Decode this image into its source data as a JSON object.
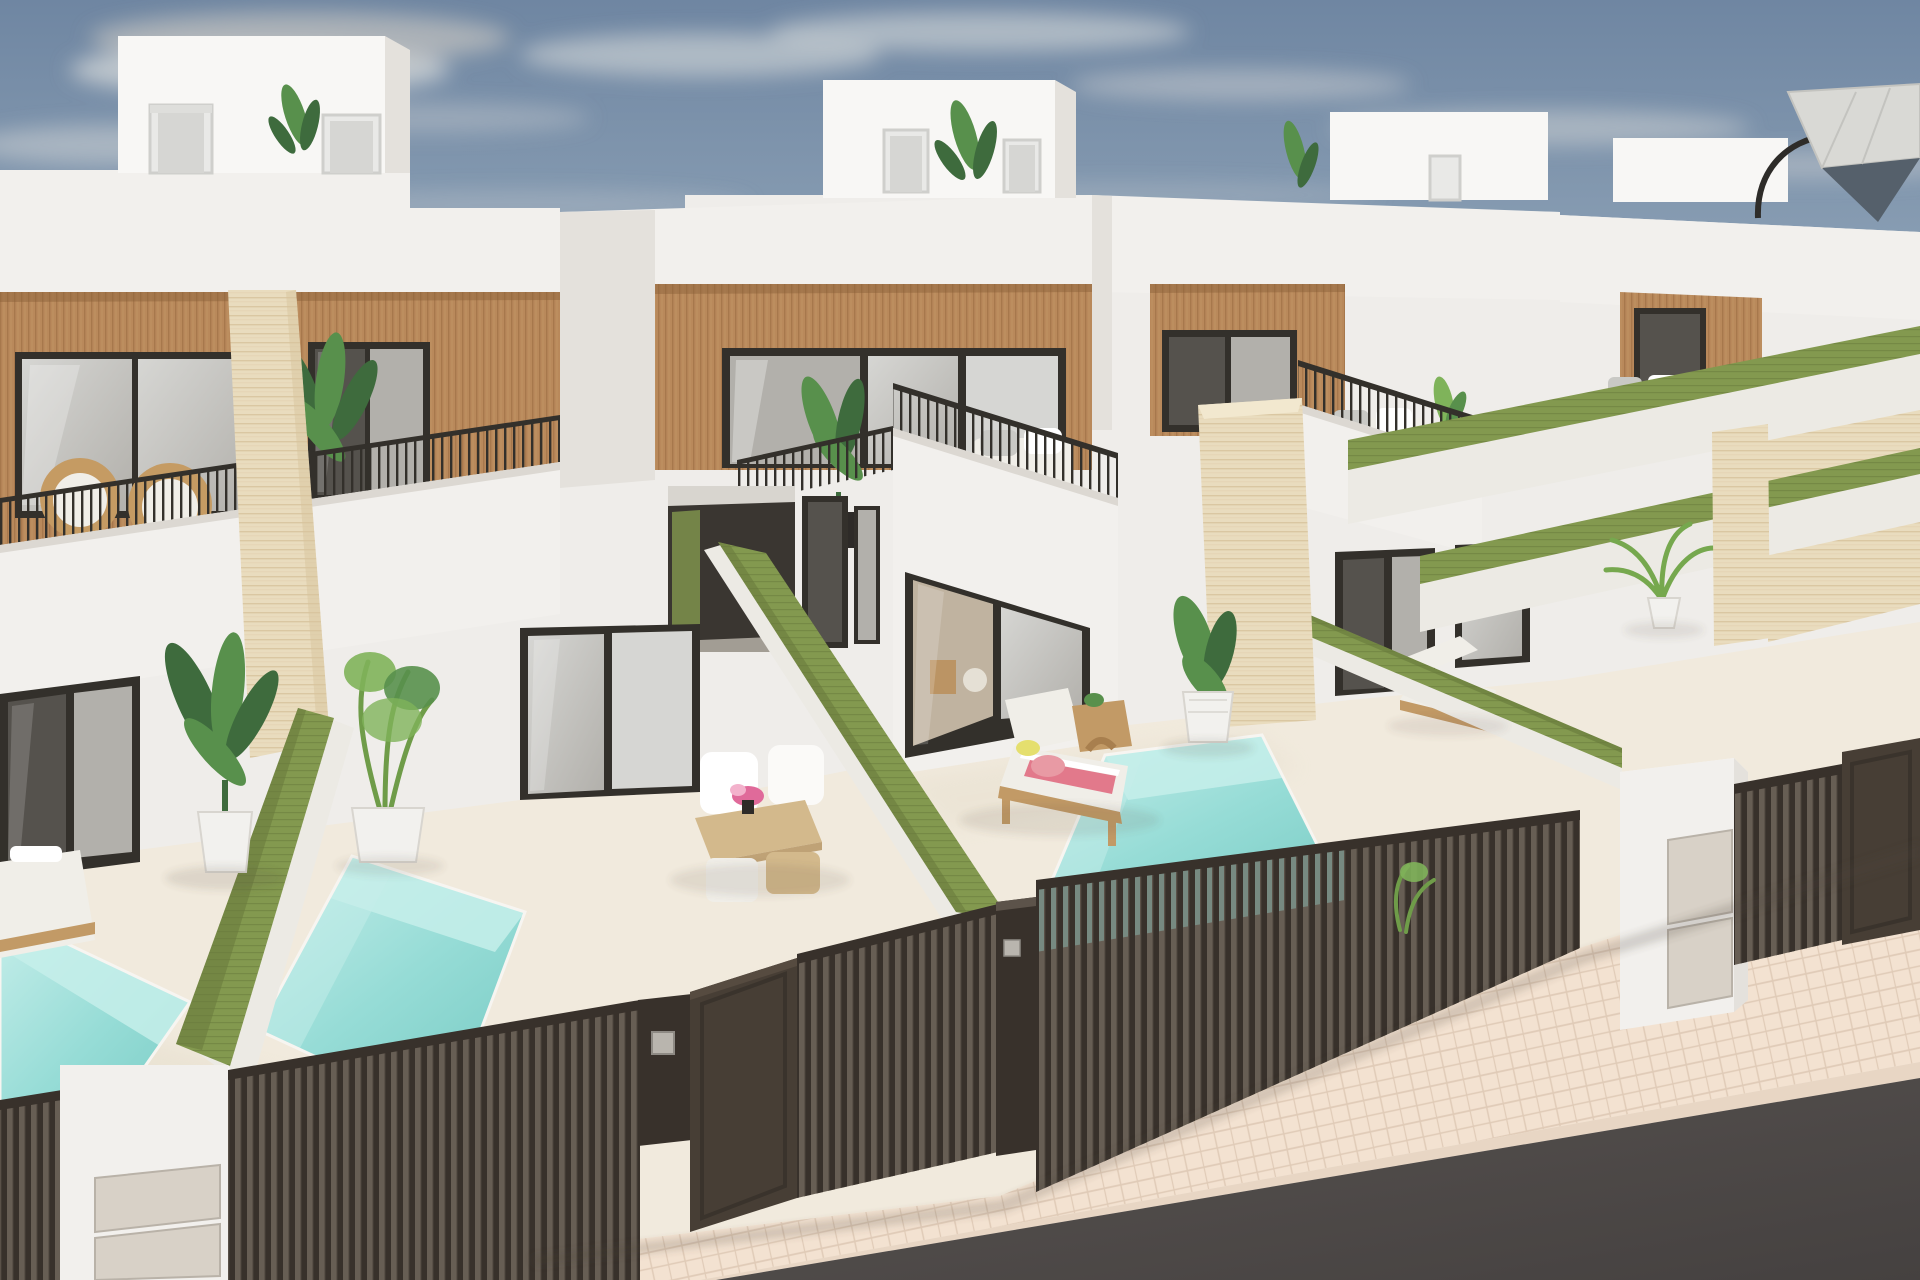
{
  "meta": {
    "title": "New-build terraced villas – exterior 3D render",
    "view": "elevated street-corner view of a row of modern townhouses with private pools",
    "time_of_day": "daytime, clear sky with thin clouds"
  },
  "palette": {
    "sky_top": "#6f86a2",
    "sky_mid": "#93a7ba",
    "sky_horizon": "#c9d0d5",
    "cloud": "#d6d8d8",
    "cloud_warm": "#d9d2c6",
    "backdrop": "#efedea",
    "wall_white": "#f2f0ed",
    "wall_bright": "#f8f7f5",
    "wall_shade": "#e4e1dc",
    "wall_shadow": "#d5d1cb",
    "wood": "#b9895b",
    "wood_dark": "#99693f",
    "frame_dark": "#33302b",
    "glass_light": "#d6d6d3",
    "glass_grey": "#b2b0ab",
    "glass_dark": "#55524d",
    "glass_interior": "#c0b3a0",
    "green_top": "#83994f",
    "green_dark": "#68793c",
    "green_face": "#eceae4",
    "travertine": "#e9dcbe",
    "travertine_line": "#d3bc94",
    "pool_light": "#c6eeea",
    "pool_mid": "#96dcd6",
    "pool_deep": "#7accc5",
    "patio": "#f1eadd",
    "patio_shade": "#e3dbc9",
    "paver": "#f3e2d1",
    "paver_line": "#e0cbb7",
    "road": "#585351",
    "road_dark": "#454140",
    "fence": "#38312b",
    "fence_gap": "#675e54",
    "fence_hi": "#5a5148",
    "rattan": "#c59b63",
    "cushion": "#f0eee8",
    "cushion_grey": "#c9c9c5",
    "towel_pink": "#e89aa4",
    "towel_red": "#e2798b",
    "accent_yellow": "#e5df6e",
    "flower_pink": "#e06a9a",
    "leaf_dark": "#3e6b3d",
    "leaf_mid": "#58904c",
    "leaf_light": "#7fb35a",
    "pot_white": "#f2f1ee",
    "pot_black": "#2e2b28",
    "table_wood": "#d3b98c",
    "wood_furniture": "#c29a66",
    "letterbox": "#d8d1c7",
    "keypad": "#b9b5ae"
  },
  "scene": {
    "houses": [
      {
        "id": "house-1",
        "position": "far left",
        "features": [
          "rooftop box with two windows and plant",
          "white parapet",
          "wood-slat cladding band",
          "light glass slider",
          "dark window",
          "upper terrace with black railing",
          "two rattan chairs",
          "strelitzia plant",
          "travertine pillar",
          "ground-floor dark slider",
          "private pool"
        ]
      },
      {
        "id": "house-2",
        "position": "center",
        "features": [
          "rooftop box with two windows and plant",
          "wood-slat band over recessed balcony",
          "balcony with railing, white sofa and potted plant",
          "dark entry passage",
          "ground-floor glass slider with furnished interior",
          "patio with dining set",
          "green privacy walls"
        ]
      },
      {
        "id": "house-3",
        "position": "right",
        "features": [
          "rooftop box with window",
          "wood-slat band with dark window",
          "balcony with white sofa and railing",
          "large travertine pillar",
          "ground-floor sliders",
          "patio with sun lounger, side table and pool"
        ]
      },
      {
        "id": "house-4",
        "position": "far right corner",
        "features": [
          "rooftop terrace with cantilever parasol",
          "wood-slat panel",
          "terrace sofa behind railing",
          "travertine wall",
          "palm plant",
          "sun lounger"
        ]
      }
    ],
    "pools": [
      {
        "id": "pool-1",
        "owner": "house-1",
        "water": "turquoise"
      },
      {
        "id": "pool-2",
        "owner": "house-2",
        "water": "turquoise"
      },
      {
        "id": "pool-3",
        "owner": "house-3",
        "water": "turquoise"
      }
    ],
    "boundaries": {
      "privacy_walls": "white walls capped with green turf tops separating each patio",
      "street_fence": "dark brown vertical-slat fences and sliding gates",
      "pillars": "white letterbox pillars with beige hatches and keypads"
    },
    "street": {
      "sidewalk": "light pink-beige paver sidewalk running diagonally",
      "road": "dark asphalt in bottom-right corner"
    }
  }
}
